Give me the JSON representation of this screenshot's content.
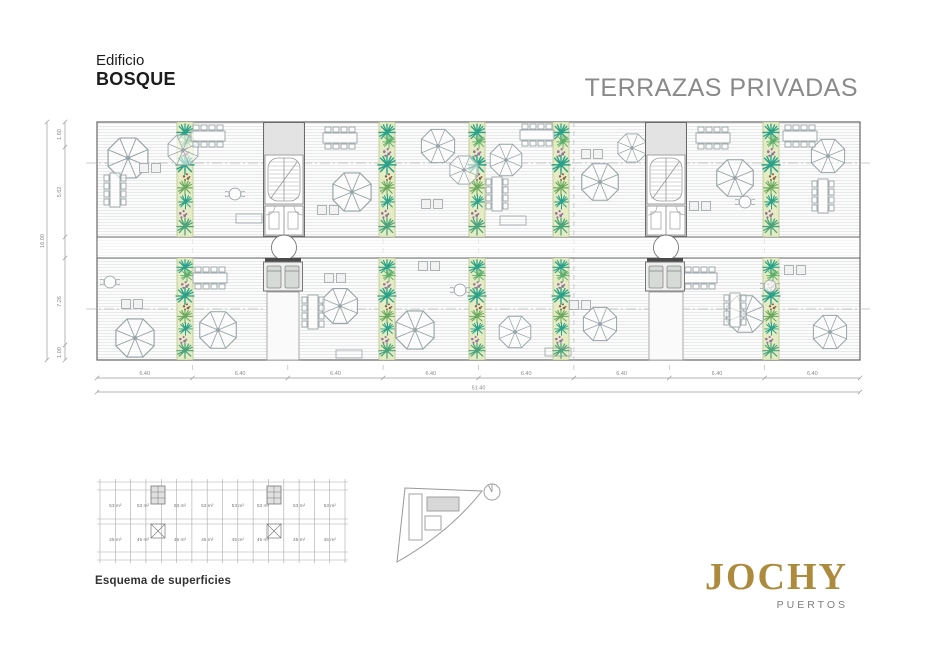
{
  "header": {
    "building_label": "Edificio",
    "building_name": "BOSQUE",
    "sheet_title": "TERRAZAS PRIVADAS"
  },
  "plan": {
    "dims_left": {
      "segments": [
        "1.60",
        "5.62",
        "7.26",
        "1.00"
      ],
      "total": "16.00"
    },
    "dims_bottom": {
      "segments": [
        "6.40",
        "6.40",
        "6.40",
        "6.40",
        "6.40",
        "6.40",
        "6.40",
        "6.40"
      ],
      "total": "51.40"
    }
  },
  "schema": {
    "caption": "Esquema de superficies",
    "top_areas": [
      "53 m²",
      "53 m²",
      "53 m²",
      "53 m²",
      "53 m²",
      "53 m²",
      "53 m²",
      "53 m²"
    ],
    "bottom_areas": [
      "45 m²",
      "45 m²",
      "45 m²",
      "45 m²",
      "45 m²",
      "45 m²",
      "45 m²",
      "45 m²"
    ]
  },
  "logo": {
    "brand": "JOCHY",
    "sub_brand": "PUERTOS",
    "brand_color": "#ac8b3d"
  },
  "colors": {
    "title_gray": "#8a8a8a",
    "plan_line": "#9aa3a6",
    "plant_teal": "#2ba189",
    "plant_green": "#63a861"
  }
}
